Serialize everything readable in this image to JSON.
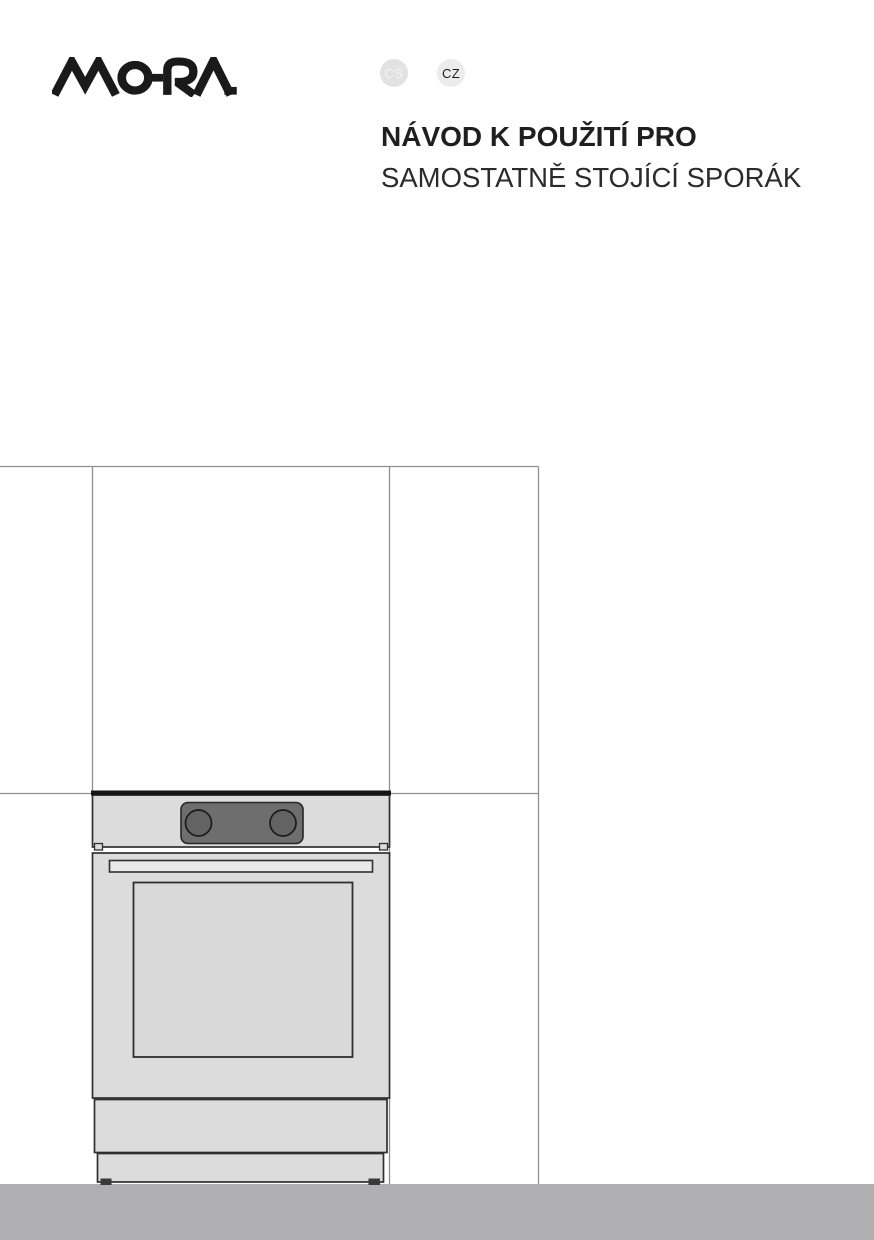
{
  "brand": {
    "name": "MORA"
  },
  "language_badges": {
    "cs": "CS",
    "cz": "CZ"
  },
  "title": {
    "line1": "NÁVOD K POUŽITÍ PRO",
    "line2": "SAMOSTATNĚ STOJÍCÍ SPORÁK"
  },
  "colors": {
    "logo": "#1a1a1a",
    "title_color": "#1f1f1f",
    "badge_cs_bg": "#e2e2e2",
    "badge_cs_text": "#f4f4f4",
    "badge_cz_bg": "#ececec",
    "badge_cz_text": "#1b1b1b",
    "wall_line": "#8f8f8f",
    "appliance_fill": "#dcdcdc",
    "glass_fill": "#d9d9d9",
    "panel_fill": "#6e6e6e",
    "knob_fill": "#636363",
    "floor": "#b0b0b2"
  }
}
